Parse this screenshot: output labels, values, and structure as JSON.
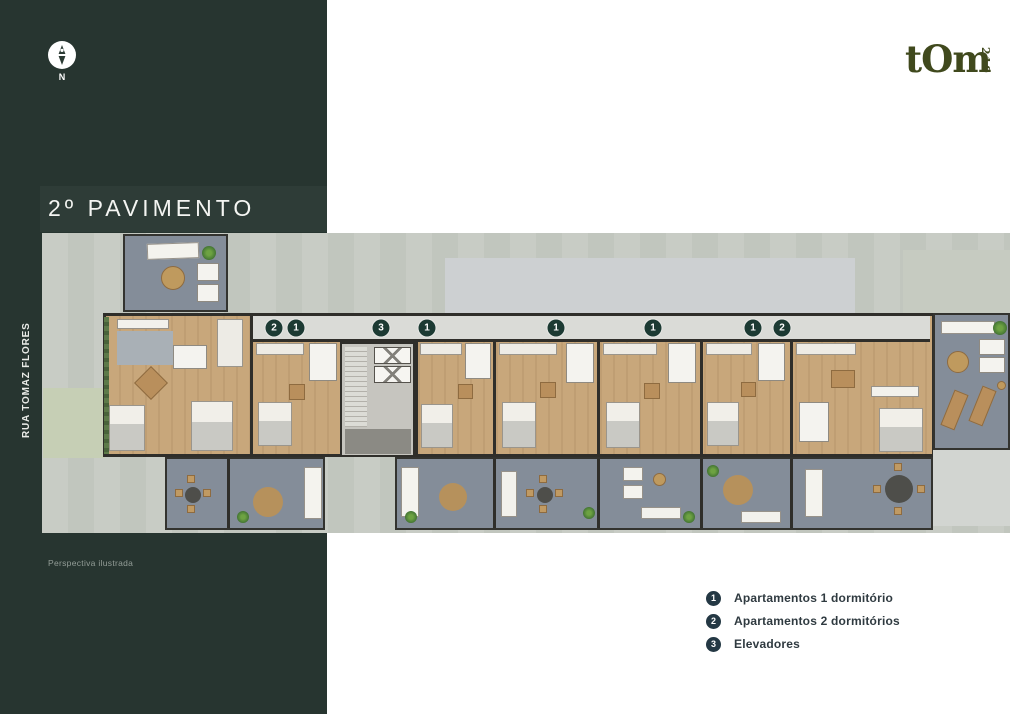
{
  "panel": {
    "title": "2º PAVIMENTO",
    "street": "RUA TOMAZ FLORES",
    "caption": "Perspectiva ilustrada",
    "compass_label": "N",
    "bg_color": "#273530"
  },
  "logo": {
    "text": "tOm",
    "number": "219",
    "color": "#40491d"
  },
  "legend": {
    "items": [
      {
        "number": "1",
        "label": "Apartamentos 1 dormitório"
      },
      {
        "number": "2",
        "label": "Apartamentos 2 dormitórios"
      },
      {
        "number": "3",
        "label": "Elevadores"
      }
    ],
    "circle_color": "#243844",
    "text_color": "#2f3a40"
  },
  "plan": {
    "badge_color": "#1c3a33",
    "wood_color": "#c8a77b",
    "terrace_color": "#848d99",
    "badges": [
      {
        "number": "2",
        "x": 232,
        "y": 95
      },
      {
        "number": "1",
        "x": 254,
        "y": 95
      },
      {
        "number": "3",
        "x": 339,
        "y": 95
      },
      {
        "number": "1",
        "x": 385,
        "y": 95
      },
      {
        "number": "1",
        "x": 514,
        "y": 95
      },
      {
        "number": "1",
        "x": 611,
        "y": 95
      },
      {
        "number": "1",
        "x": 711,
        "y": 95
      },
      {
        "number": "2",
        "x": 740,
        "y": 95
      }
    ]
  }
}
